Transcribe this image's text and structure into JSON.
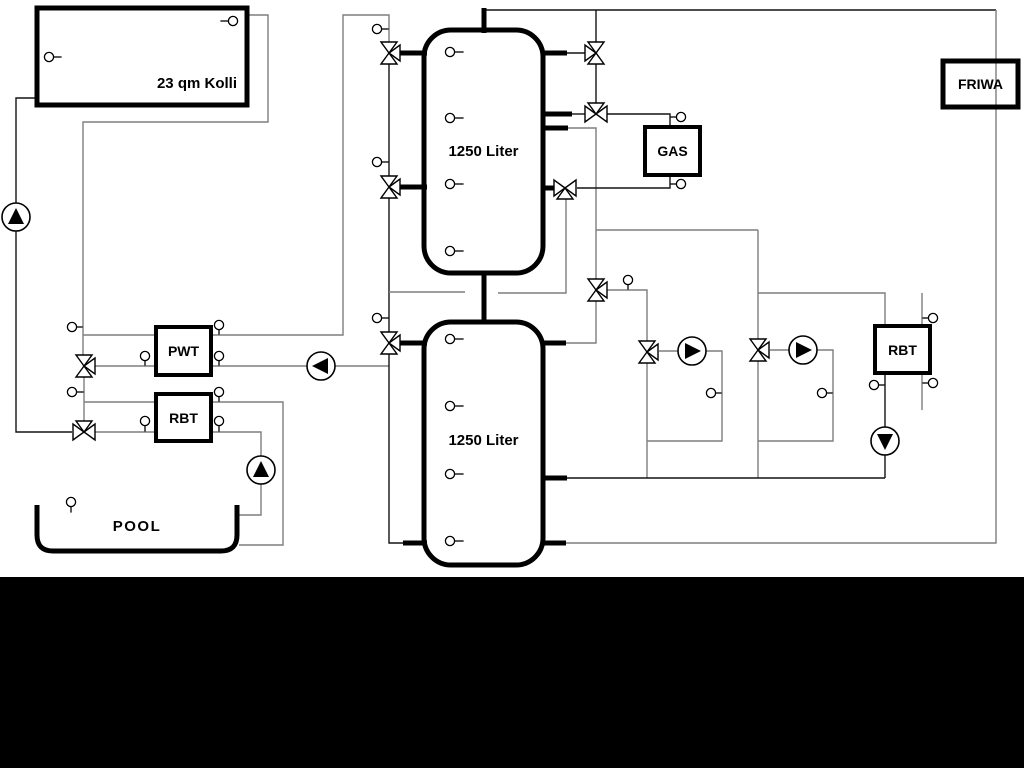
{
  "labels": {
    "collector": "23 qm Kolli",
    "tank_top": "1250 Liter",
    "tank_bottom": "1250 Liter",
    "gas": "GAS",
    "friwa": "FRIWA",
    "pwt": "PWT",
    "rbt_left": "RBT",
    "rbt_right": "RBT",
    "pool": "POOL"
  },
  "colors": {
    "background": "#ffffff",
    "bottom_bar": "#000000",
    "pipe_gray": "#7e7e7e",
    "pipe_black": "#141414",
    "outline": "#000000",
    "fill": "#ffffff"
  },
  "schematic": {
    "pipes": [
      {
        "d": "M37 98 H16 V204",
        "c": "k"
      },
      {
        "d": "M16 230 V432 H72",
        "c": "k"
      },
      {
        "d": "M247 15 H268 V122 H83 V355",
        "c": "g"
      },
      {
        "d": "M83 335 H343 V15 H389 V42",
        "c": "g"
      },
      {
        "d": "M95 366 H307",
        "c": "g"
      },
      {
        "d": "M335 366 H389",
        "c": "g"
      },
      {
        "d": "M389 64 V176",
        "c": "k"
      },
      {
        "d": "M389 198 V332",
        "c": "k"
      },
      {
        "d": "M389 354 V543 H404",
        "c": "k"
      },
      {
        "d": "M484 10 H996",
        "c": "k"
      },
      {
        "d": "M996 10 V543 H566",
        "c": "g"
      },
      {
        "d": "M596 10 V42",
        "c": "k"
      },
      {
        "d": "M596 64 V103",
        "c": "k"
      },
      {
        "d": "M566 53 H585",
        "c": "k"
      },
      {
        "d": "M570 114 H585",
        "c": "k"
      },
      {
        "d": "M567 128 H596 V279",
        "c": "g"
      },
      {
        "d": "M596 230 H758",
        "c": "g"
      },
      {
        "d": "M758 230 V339",
        "c": "g"
      },
      {
        "d": "M758 361 V478",
        "c": "g"
      },
      {
        "d": "M607 290 H647 V341",
        "c": "g"
      },
      {
        "d": "M647 363 V478",
        "c": "g"
      },
      {
        "d": "M389 292 H465",
        "c": "g"
      },
      {
        "d": "M498 293 H566 V199",
        "c": "g"
      },
      {
        "d": "M596 301 V343 H566",
        "c": "g"
      },
      {
        "d": "M607 114 H670 V127",
        "c": "k"
      },
      {
        "d": "M577 188 H670 V175",
        "c": "k"
      },
      {
        "d": "M659 351 H678",
        "c": "g"
      },
      {
        "d": "M706 351 H722 V441 H647",
        "c": "g"
      },
      {
        "d": "M770 350 H789",
        "c": "g"
      },
      {
        "d": "M817 350 H833 V441 H758",
        "c": "g"
      },
      {
        "d": "M758 293 H885 V326",
        "c": "g"
      },
      {
        "d": "M885 373 V427",
        "c": "k"
      },
      {
        "d": "M885 455 V478",
        "c": "k"
      },
      {
        "d": "M566 478 H885",
        "c": "k"
      },
      {
        "d": "M922 293 V410",
        "c": "g"
      },
      {
        "d": "M84 377 V421",
        "c": "g"
      },
      {
        "d": "M84 402 H156",
        "c": "g"
      },
      {
        "d": "M211 402 H283 V545 H239",
        "c": "g"
      },
      {
        "d": "M95 432 H156",
        "c": "g"
      },
      {
        "d": "M211 432 H261 V456",
        "c": "g"
      },
      {
        "d": "M261 484 V515 H239",
        "c": "g"
      }
    ],
    "vessels": [
      {
        "name": "collector-box",
        "x": 37,
        "y": 8,
        "w": 210,
        "h": 97,
        "rx": 0,
        "sw": 5,
        "fill": "white"
      },
      {
        "name": "buffer-tank-top",
        "x": 424,
        "y": 30,
        "w": 119,
        "h": 243,
        "rx": 27,
        "sw": 5,
        "fill": "white"
      },
      {
        "name": "buffer-tank-bottom",
        "x": 424,
        "y": 322,
        "w": 119,
        "h": 243,
        "rx": 27,
        "sw": 5,
        "fill": "white"
      },
      {
        "name": "gas-boiler-box",
        "x": 645,
        "y": 127,
        "w": 55,
        "h": 48,
        "rx": 0,
        "sw": 4,
        "fill": "white"
      },
      {
        "name": "friwa-box",
        "x": 943,
        "y": 61,
        "w": 75,
        "h": 46,
        "rx": 0,
        "sw": 5,
        "fill": "none"
      },
      {
        "name": "pwt-heat-exchanger-box",
        "x": 156,
        "y": 327,
        "w": 55,
        "h": 48,
        "rx": 0,
        "sw": 4,
        "fill": "white"
      },
      {
        "name": "rbt-heat-exchanger-left-box",
        "x": 156,
        "y": 394,
        "w": 55,
        "h": 47,
        "rx": 0,
        "sw": 4,
        "fill": "white"
      },
      {
        "name": "rbt-heat-exchanger-right-box",
        "x": 875,
        "y": 326,
        "w": 55,
        "h": 47,
        "rx": 0,
        "sw": 4,
        "fill": "white"
      }
    ],
    "pool_outline": {
      "d": "M37 505 V535 Q37 551 53 551 H221 Q237 551 237 535 V505",
      "sw": 5
    },
    "stubs": [
      "M398 53 H427",
      "M398 187 H427",
      "M541 53 H567",
      "M541 114 H572",
      "M541 128 H568",
      "M541 188 H554",
      "M484 8 V33",
      "M484 271 V324",
      "M398 343 H427",
      "M403 543 H427",
      "M541 343 H566",
      "M541 478 H567",
      "M541 543 H566"
    ],
    "valves": [
      {
        "x": 389,
        "y": 53,
        "b": "udr"
      },
      {
        "x": 389,
        "y": 187,
        "b": "udr"
      },
      {
        "x": 389,
        "y": 343,
        "b": "udr"
      },
      {
        "x": 596,
        "y": 53,
        "b": "lud"
      },
      {
        "x": 596,
        "y": 114,
        "b": "lru"
      },
      {
        "x": 565,
        "y": 188,
        "b": "lrd"
      },
      {
        "x": 596,
        "y": 290,
        "b": "udr"
      },
      {
        "x": 647,
        "y": 352,
        "b": "udr"
      },
      {
        "x": 758,
        "y": 350,
        "b": "udr"
      },
      {
        "x": 84,
        "y": 366,
        "b": "udr"
      },
      {
        "x": 84,
        "y": 432,
        "b": "lru"
      }
    ],
    "pumps": [
      {
        "x": 16,
        "y": 217,
        "dir": "u"
      },
      {
        "x": 321,
        "y": 366,
        "dir": "l"
      },
      {
        "x": 261,
        "y": 470,
        "dir": "u"
      },
      {
        "x": 692,
        "y": 351,
        "dir": "r"
      },
      {
        "x": 803,
        "y": 350,
        "dir": "r"
      },
      {
        "x": 885,
        "y": 441,
        "dir": "d"
      }
    ],
    "sensors": [
      {
        "x": 233,
        "y": 21,
        "s": "l",
        "n": 8
      },
      {
        "x": 49,
        "y": 57,
        "s": "r",
        "n": 8
      },
      {
        "x": 377,
        "y": 29,
        "s": "r",
        "n": 7
      },
      {
        "x": 377,
        "y": 162,
        "s": "r",
        "n": 7
      },
      {
        "x": 377,
        "y": 318,
        "s": "r",
        "n": 7
      },
      {
        "x": 450,
        "y": 52,
        "s": "r",
        "n": 9
      },
      {
        "x": 450,
        "y": 118,
        "s": "r",
        "n": 9
      },
      {
        "x": 450,
        "y": 184,
        "s": "r",
        "n": 9
      },
      {
        "x": 450,
        "y": 251,
        "s": "r",
        "n": 9
      },
      {
        "x": 450,
        "y": 339,
        "s": "r",
        "n": 9
      },
      {
        "x": 450,
        "y": 406,
        "s": "r",
        "n": 9
      },
      {
        "x": 450,
        "y": 474,
        "s": "r",
        "n": 9
      },
      {
        "x": 450,
        "y": 541,
        "s": "r",
        "n": 9
      },
      {
        "x": 628,
        "y": 280,
        "s": "d",
        "n": 5
      },
      {
        "x": 681,
        "y": 117,
        "s": "l",
        "n": 6
      },
      {
        "x": 681,
        "y": 184,
        "s": "l",
        "n": 6
      },
      {
        "x": 145,
        "y": 356,
        "s": "d",
        "n": 5
      },
      {
        "x": 219,
        "y": 325,
        "s": "d",
        "n": 5
      },
      {
        "x": 219,
        "y": 356,
        "s": "d",
        "n": 5
      },
      {
        "x": 72,
        "y": 327,
        "s": "r",
        "n": 6
      },
      {
        "x": 72,
        "y": 392,
        "s": "r",
        "n": 7
      },
      {
        "x": 145,
        "y": 421,
        "s": "d",
        "n": 6
      },
      {
        "x": 219,
        "y": 392,
        "s": "d",
        "n": 5
      },
      {
        "x": 219,
        "y": 421,
        "s": "d",
        "n": 6
      },
      {
        "x": 71,
        "y": 502,
        "s": "d",
        "n": 6
      },
      {
        "x": 711,
        "y": 393,
        "s": "r",
        "n": 6
      },
      {
        "x": 822,
        "y": 393,
        "s": "r",
        "n": 6
      },
      {
        "x": 874,
        "y": 385,
        "s": "r",
        "n": 6
      },
      {
        "x": 933,
        "y": 318,
        "s": "l",
        "n": 6
      },
      {
        "x": 933,
        "y": 383,
        "s": "l",
        "n": 6
      }
    ]
  }
}
